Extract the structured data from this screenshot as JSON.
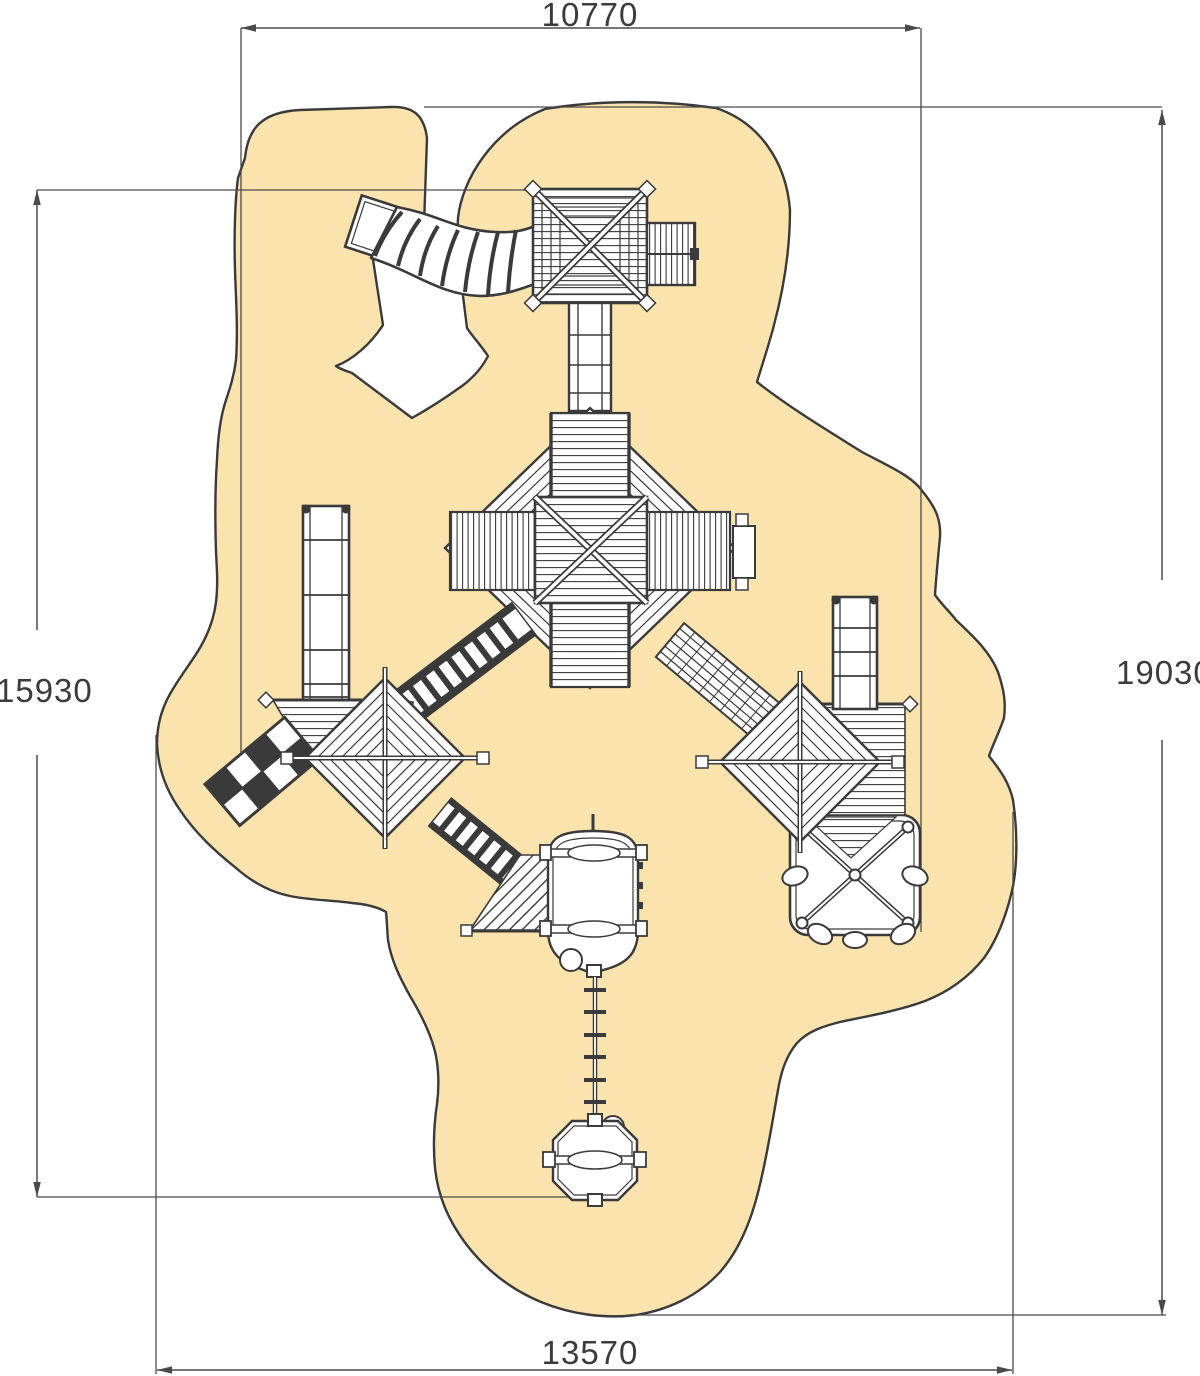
{
  "meta": {
    "title": "Playground equipment top-view plan with safety zone"
  },
  "dimensions": {
    "top": "10770",
    "left": "15930",
    "right": "19030",
    "bottom": "13570"
  },
  "colors": {
    "safety_zone": "#FAE3AD",
    "outline": "#3A3A3A",
    "dimension_line": "#4A4A4A",
    "background": "#FFFFFF"
  },
  "elements": [
    "safety-zone-surface",
    "tube-slide",
    "slide-exit-box",
    "top-square-tower",
    "climbing-panel",
    "north-bridge",
    "main-octagon-tower",
    "west-ladder",
    "west-diamond-tower",
    "checker-climbing-net",
    "net-tunnel-northeast",
    "net-tunnel-southeast",
    "east-ramp-bridge",
    "east-diamond-tower",
    "east-ladder",
    "east-stairs-platform",
    "membrane-climber",
    "basket-pod",
    "pod-platform",
    "rope-ladder",
    "swing-pod"
  ]
}
